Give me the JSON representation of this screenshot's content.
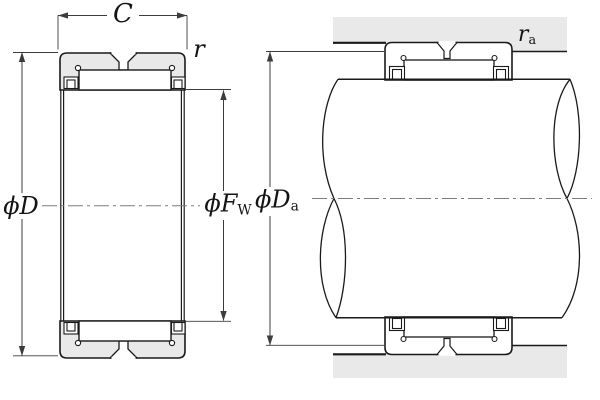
{
  "drawing": {
    "description": "Needle roller bearing (without inner ring): dimensioned cross-section on the left, shaft and housing mounting arrangement on the right",
    "views": {
      "left": "bearing cross-section",
      "right": "mounted arrangement with shaft and housing"
    }
  },
  "labels": {
    "width": {
      "text": "C"
    },
    "chamfer": {
      "text": "r"
    },
    "outer_dia": {
      "text": "ϕD"
    },
    "raceway_dia": {
      "main": "ϕF",
      "sub": "W"
    },
    "abutment_dia": {
      "main": "ϕD",
      "sub": "a"
    },
    "fillet_radius": {
      "main": "r",
      "sub": "a"
    }
  },
  "colors": {
    "section_fill": "#e9e9e9",
    "outline": "#1a1a1a",
    "dimension_line": "#3c3c3c",
    "centerline": "#7d7d7d",
    "background": "#ffffff"
  }
}
